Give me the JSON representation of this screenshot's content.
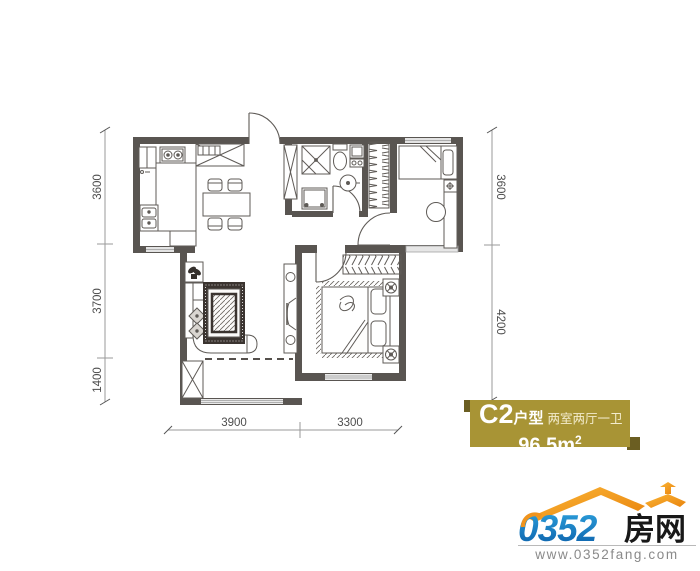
{
  "dims": {
    "left": [
      "3600",
      "3700",
      "1400"
    ],
    "right": [
      "3600",
      "4200"
    ],
    "bottom": [
      "3900",
      "3300"
    ]
  },
  "badge": {
    "code": "C2",
    "type_label": "户型",
    "rooms": "两室两厅一卫",
    "area_value": "96.5m",
    "area_sup": "2",
    "bg_color": "#a89435",
    "corner_color": "#6b5e22"
  },
  "logo": {
    "number": "0352",
    "cn": "房网",
    "url": "www.0352fang.com",
    "roof_color": "#f59a1d",
    "blue_color": "#1375bd"
  },
  "colors": {
    "wall": "#595551",
    "furniture_line": "#5f5b57",
    "dimension_text": "#4d4d4d"
  }
}
